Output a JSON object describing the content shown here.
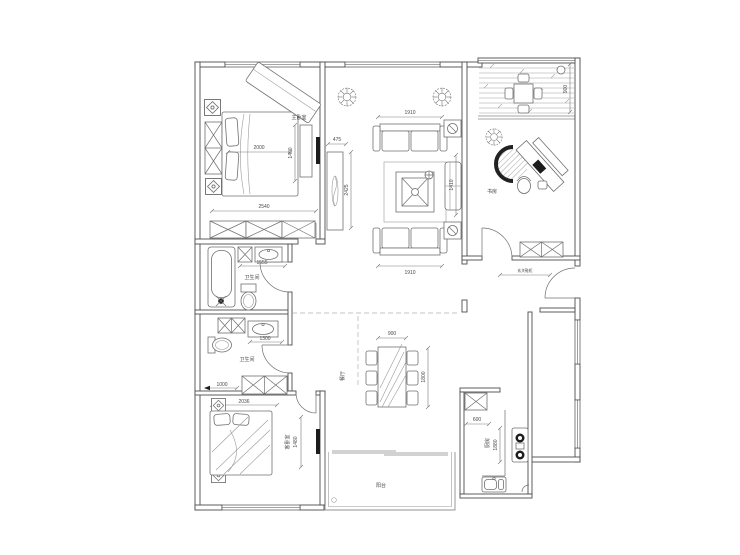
{
  "plan": {
    "type": "apartment-floor-plan",
    "rooms": {
      "master_bedroom": "主卧室",
      "study": "书房",
      "bathroom_top": "卫生间",
      "bathroom_bottom": "卫生间",
      "guest_bedroom": "客卧室",
      "dining": "餐厅",
      "kitchen": "厨房",
      "balcony": "阳台",
      "entry_cabinet": "玄关鞋柜"
    },
    "dims": {
      "bed_w": "2000",
      "bed_l": "1400",
      "master_w": "2540",
      "tv_offset": "475",
      "tv_wall": "2425",
      "sofa_top": "1910",
      "sofa_bottom": "1910",
      "living_side": "1410",
      "terrace_d": "900",
      "bath_top_w": "1555",
      "bath_bottom_w": "1300",
      "hall": "1000",
      "guest_w": "2036",
      "guest_bed": "1480",
      "table_w": "900",
      "table_l": "1800",
      "kitchen_cab": "600",
      "kitchen_d": "1880"
    },
    "colors": {
      "wall": "#4d4d4d",
      "furniture": "#707070",
      "text": "#4a4a4a",
      "accent_dark": "#1c1c1c",
      "background": "#ffffff"
    }
  }
}
